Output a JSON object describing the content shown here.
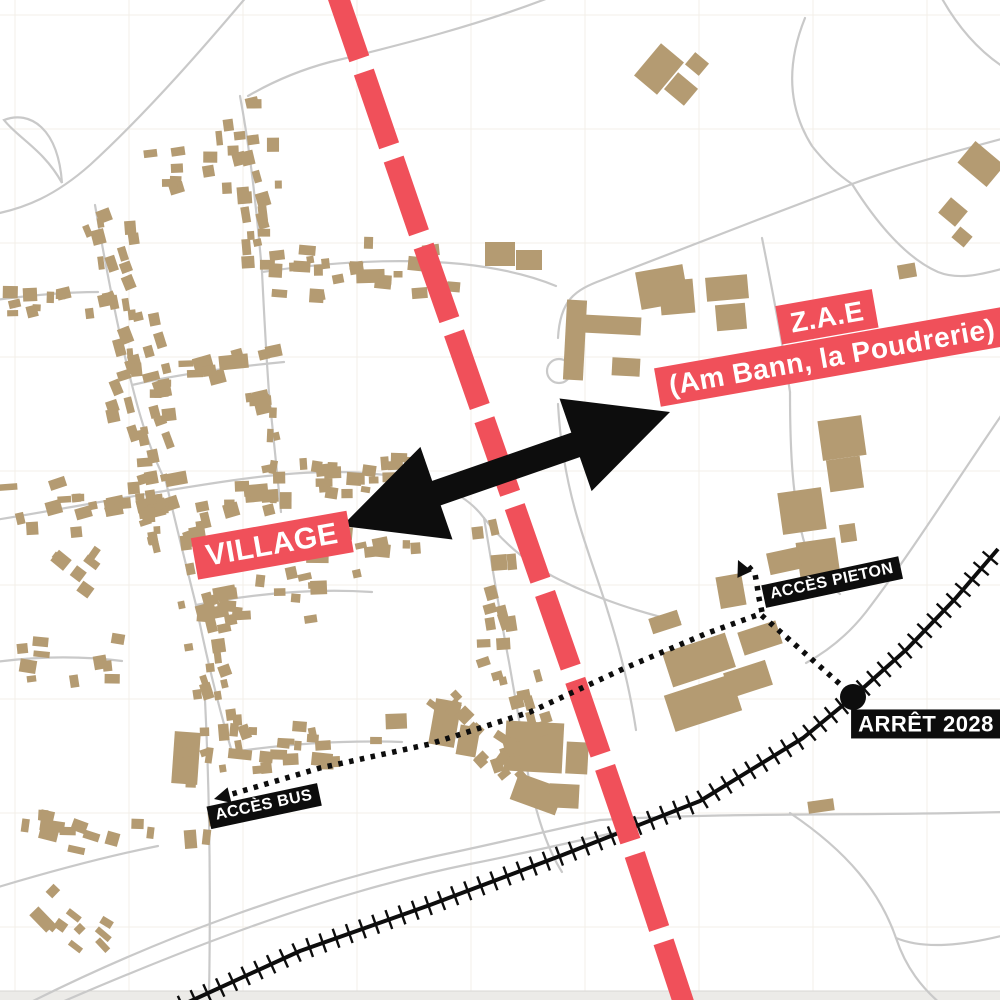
{
  "map": {
    "description_labels": [
      "VILLAGE",
      "Z.A.E",
      "(Am Bann, la Poudrerie)",
      "ACCÈS PIETON",
      "ACCÈS BUS",
      "ARRÊT 2028"
    ],
    "colors": {
      "background": "#ffffff",
      "grid": "#f3efe9",
      "road": "#c9c9c9",
      "building": "#b49b72",
      "accent_red": "#f0505a",
      "black": "#0d0d0d",
      "label_text": "#ffffff",
      "bottom_strip": "#ecebe8"
    },
    "labels": {
      "village": {
        "text": "VILLAGE",
        "cx": 272,
        "cy": 545,
        "rot": -10,
        "font": 30,
        "style": "red"
      },
      "zae_line1": {
        "text": "Z.A.E",
        "cx": 827,
        "cy": 317,
        "rot": -10,
        "font": 28,
        "style": "red"
      },
      "zae_line2": {
        "text": "(Am Bann, la Poudrerie)",
        "cx": 832,
        "cy": 357,
        "rot": -10,
        "font": 28,
        "style": "red"
      },
      "acces_pieton": {
        "text": "ACCÈS PIETON",
        "cx": 832,
        "cy": 582,
        "rot": -12,
        "font": 16,
        "style": "black"
      },
      "acces_bus": {
        "text": "ACCÈS BUS",
        "cx": 264,
        "cy": 806,
        "rot": -12,
        "font": 16,
        "style": "black"
      },
      "arret_2028": {
        "text": "ARRÊT 2028",
        "cx": 926,
        "cy": 724,
        "rot": 0,
        "font": 22,
        "style": "black"
      }
    },
    "overlays": {
      "project_line": {
        "color": "#f0505a",
        "width": 21,
        "dash": [
          78,
          14
        ],
        "points": [
          [
            334,
            -15
          ],
          [
            418,
            230
          ],
          [
            502,
            470
          ],
          [
            570,
            665
          ],
          [
            630,
            840
          ],
          [
            686,
            1010
          ]
        ]
      },
      "double_arrow": {
        "color": "#0d0d0d",
        "tip_left": [
          342,
          526
        ],
        "tip_right": [
          670,
          412
        ],
        "shaft_width": 26,
        "head_length": 100,
        "head_width": 98
      },
      "bus_route": {
        "color": "#0d0d0d",
        "width": 5.5,
        "dash": [
          4.5,
          6.5
        ],
        "points": [
          [
            222,
            797
          ],
          [
            320,
            768
          ],
          [
            430,
            744
          ],
          [
            530,
            712
          ],
          [
            625,
            668
          ],
          [
            705,
            634
          ],
          [
            760,
            614
          ],
          [
            792,
            642
          ],
          [
            824,
            670
          ],
          [
            850,
            693
          ]
        ],
        "arrow_tip": [
          214,
          799
        ]
      },
      "pieton_route": {
        "color": "#0d0d0d",
        "width": 5.5,
        "dash": [
          4.5,
          6.5
        ],
        "points": [
          [
            762,
            612
          ],
          [
            759,
            598
          ],
          [
            757,
            585
          ],
          [
            755,
            574
          ],
          [
            748,
            566
          ],
          [
            744,
            563
          ]
        ],
        "arrow_tip": [
          738,
          560
        ]
      },
      "railway": {
        "color": "#0d0d0d",
        "width": 4,
        "tick_spacing": 14,
        "tick_length": 20,
        "points": [
          [
            182,
            1005
          ],
          [
            300,
            951
          ],
          [
            430,
            905
          ],
          [
            560,
            856
          ],
          [
            700,
            801
          ],
          [
            803,
            738
          ],
          [
            853,
            697
          ],
          [
            907,
            649
          ],
          [
            955,
            599
          ],
          [
            998,
            549
          ]
        ]
      },
      "station": {
        "cx": 853,
        "cy": 697,
        "r": 13
      }
    }
  }
}
